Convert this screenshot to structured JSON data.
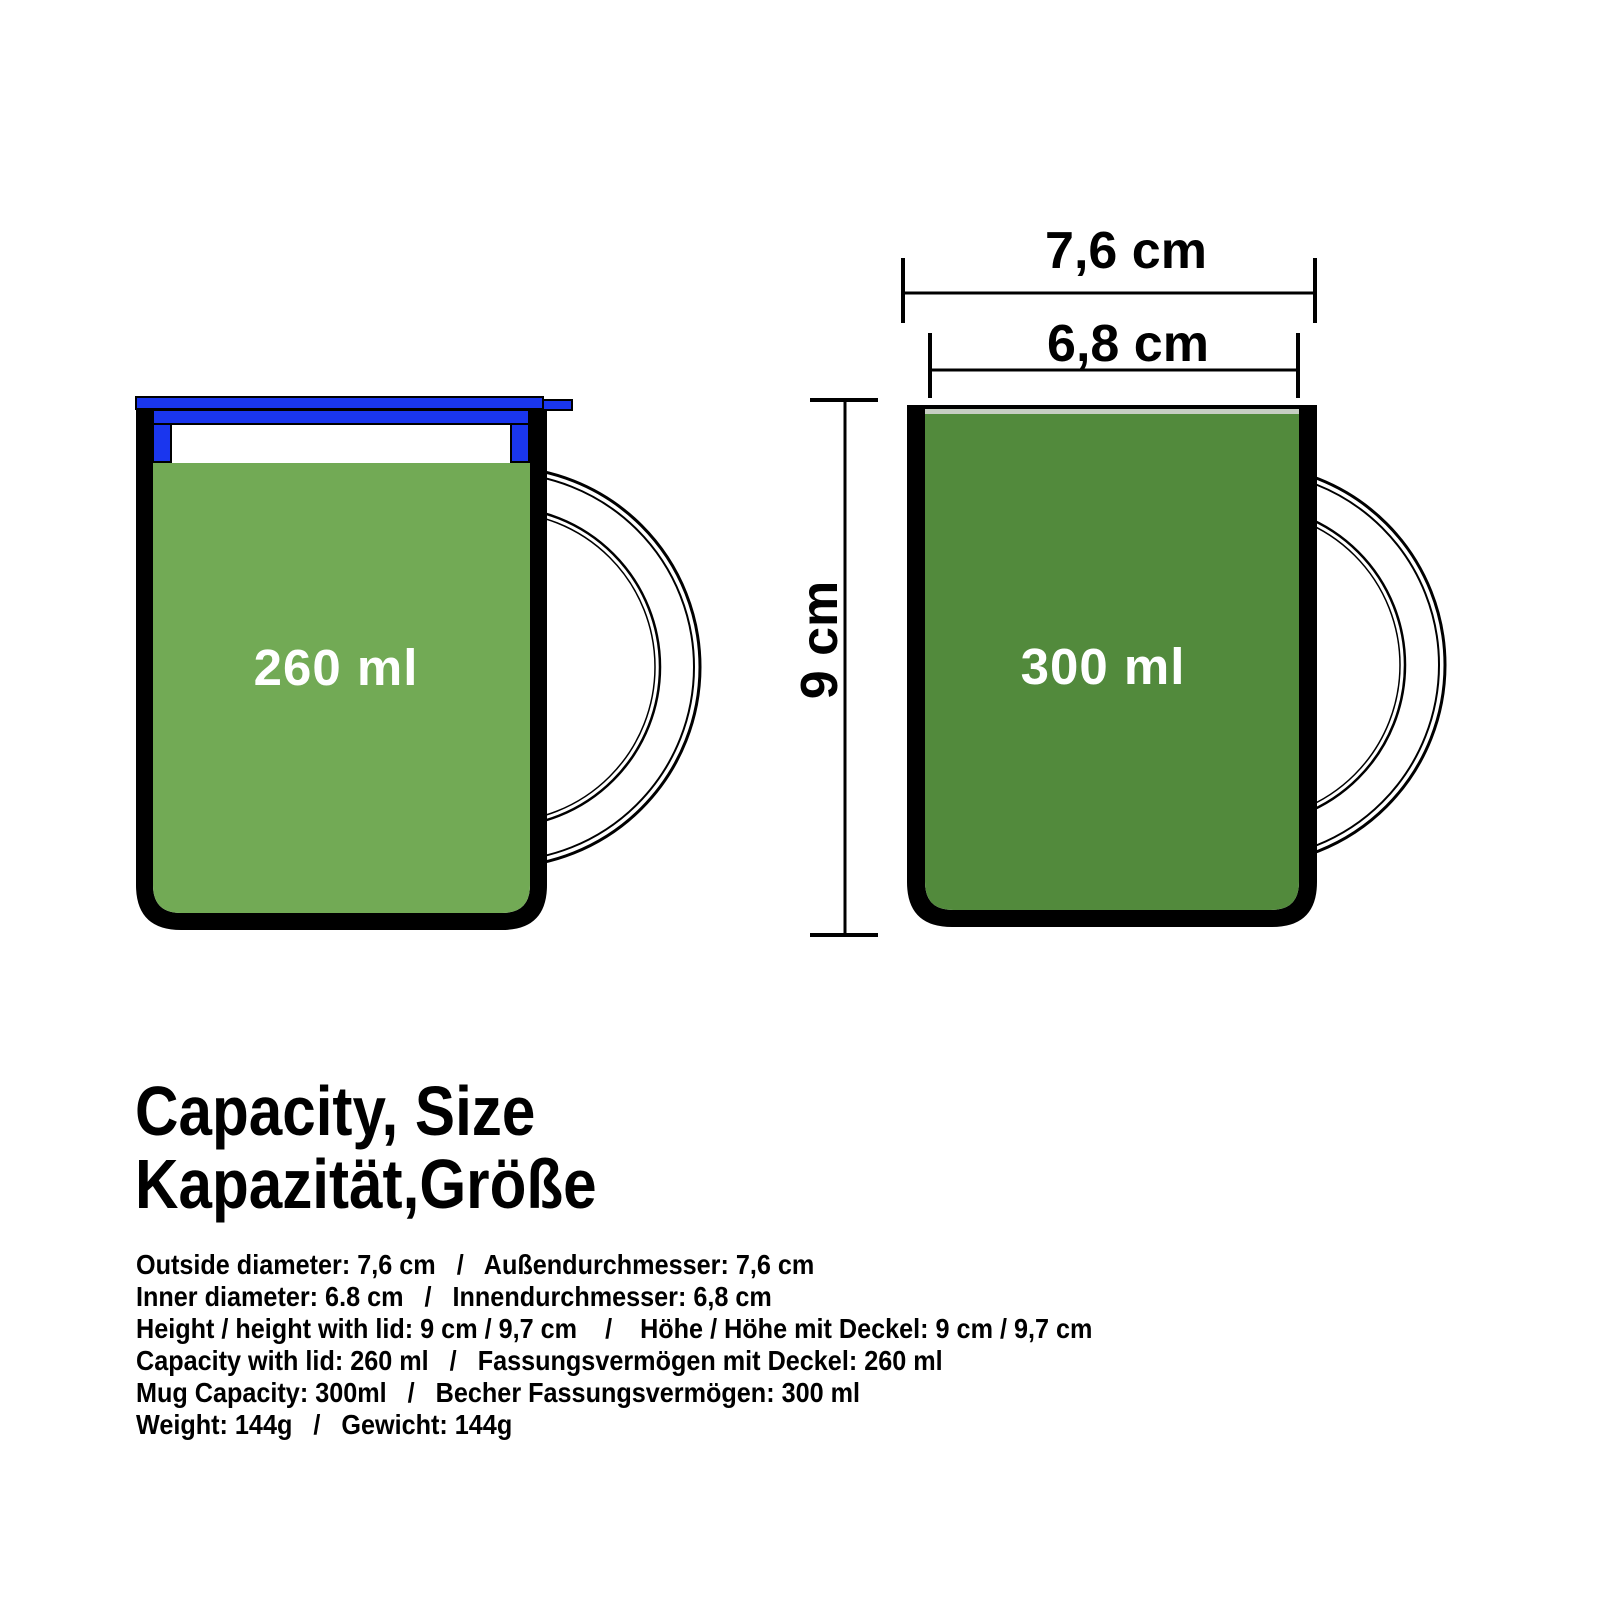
{
  "title_block": {
    "line1": "Capacity, Size",
    "line2": "Kapazität,Größe"
  },
  "dimensions": {
    "outer_diameter": "7,6 cm",
    "inner_diameter": "6,8 cm",
    "height": "9 cm"
  },
  "mugs": {
    "left": {
      "capacity": "260 ml",
      "lid": "blue-lid-with-plug"
    },
    "right": {
      "capacity": "300 ml",
      "lid": "none"
    }
  },
  "specs": [
    "Outside diameter: 7,6 cm   /   Außendurchmesser: 7,6 cm",
    "Inner diameter: 6.8 cm   /   Innendurchmesser: 6,8 cm",
    "Height / height with lid: 9 cm / 9,7 cm    /    Höhe / Höhe mit Deckel: 9 cm / 9,7 cm",
    "Capacity with lid: 260 ml   /   Fassungsvermögen mit Deckel: 260 ml",
    "Mug Capacity: 300ml   /   Becher Fassungsvermögen: 300 ml",
    "Weight: 144g   /   Gewicht: 144g"
  ],
  "colors": {
    "lid_blue": "#1a36ee",
    "left_mug_green": "#72aa55",
    "right_mug_green": "#528a3c",
    "rim_gray": "#c7cfc3",
    "outline_black": "#000000",
    "label_white": "#ffffff",
    "background": "#ffffff"
  }
}
